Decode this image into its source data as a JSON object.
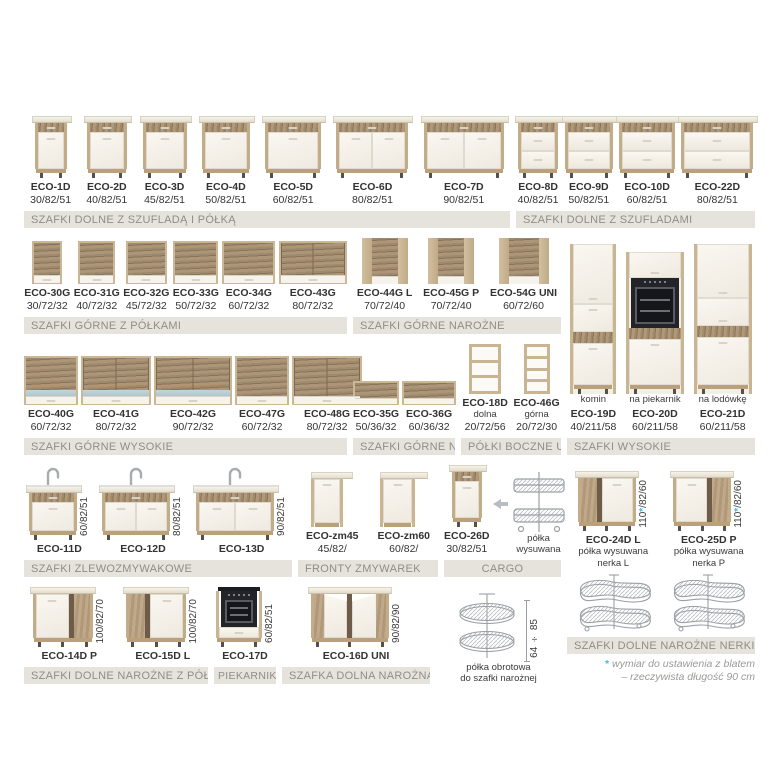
{
  "colors": {
    "accent": "#45b7e6",
    "bar_bg": "#e6e3dd",
    "bar_text": "#8f8d88",
    "text": "#3a3a3a",
    "line_art": "#9ba0a5",
    "wood": "#b0997a",
    "door": "#f7f4ed"
  },
  "sections": {
    "s1": {
      "title": "SZAFKI DOLNE Z SZUFLADĄ I PÓŁKĄ",
      "items": [
        {
          "name": "ECO-1D",
          "dims": "30/82/51",
          "kind": "base1",
          "w": 32
        },
        {
          "name": "ECO-2D",
          "dims": "40/82/51",
          "kind": "base1",
          "w": 40
        },
        {
          "name": "ECO-3D",
          "dims": "45/82/51",
          "kind": "base1",
          "w": 44
        },
        {
          "name": "ECO-4D",
          "dims": "50/82/51",
          "kind": "base1",
          "w": 48
        },
        {
          "name": "ECO-5D",
          "dims": "60/82/51",
          "kind": "base1",
          "w": 56
        },
        {
          "name": "ECO-6D",
          "dims": "80/82/51",
          "kind": "base2",
          "w": 72
        },
        {
          "name": "ECO-7D",
          "dims": "90/82/51",
          "kind": "base2",
          "w": 80
        }
      ]
    },
    "s2": {
      "title": "SZAFKI DOLNE Z SZUFLADAMI",
      "items": [
        {
          "name": "ECO-8D",
          "dims": "40/82/51",
          "kind": "drawers",
          "w": 40
        },
        {
          "name": "ECO-9D",
          "dims": "50/82/51",
          "kind": "drawers",
          "w": 48
        },
        {
          "name": "ECO-10D",
          "dims": "60/82/51",
          "kind": "drawers",
          "w": 56
        },
        {
          "name": "ECO-22D",
          "dims": "80/82/51",
          "kind": "drawers",
          "w": 72
        }
      ]
    },
    "s3": {
      "title": "SZAFKI GÓRNE Z PÓŁKAMI",
      "items": [
        {
          "name": "ECO-30G",
          "dims": "30/72/32",
          "kind": "wall",
          "w": 26
        },
        {
          "name": "ECO-31G",
          "dims": "40/72/32",
          "kind": "wall",
          "w": 33
        },
        {
          "name": "ECO-32G",
          "dims": "45/72/32",
          "kind": "wall",
          "w": 37
        },
        {
          "name": "ECO-33G",
          "dims": "50/72/32",
          "kind": "wall",
          "w": 41
        },
        {
          "name": "ECO-34G",
          "dims": "60/72/32",
          "kind": "wall",
          "w": 49
        },
        {
          "name": "ECO-43G",
          "dims": "80/72/32",
          "kind": "wall2",
          "w": 64
        }
      ]
    },
    "s4": {
      "title": "SZAFKI GÓRNE NAROŻNE",
      "items": [
        {
          "name": "ECO-44G L",
          "dims": "70/72/40",
          "kind": "cornerwall",
          "w": 46
        },
        {
          "name": "ECO-45G P",
          "dims": "70/72/40",
          "kind": "cornerwall",
          "w": 46
        },
        {
          "name": "ECO-54G UNI",
          "dims": "60/72/60",
          "kind": "cornerwall",
          "w": 50
        }
      ]
    },
    "s5": {
      "title": "SZAFKI GÓRNE WYSOKIE",
      "items": [
        {
          "name": "ECO-40G",
          "dims": "60/72/32",
          "kind": "wallhigh",
          "w": 50,
          "glass": true
        },
        {
          "name": "ECO-41G",
          "dims": "80/72/32",
          "kind": "wallhigh",
          "w": 66,
          "glass": true
        },
        {
          "name": "ECO-42G",
          "dims": "90/72/32",
          "kind": "wallhigh",
          "w": 74,
          "glass": true
        },
        {
          "name": "ECO-47G",
          "dims": "60/72/32",
          "kind": "wallhigh",
          "w": 50
        },
        {
          "name": "ECO-48G",
          "dims": "80/72/32",
          "kind": "wallhigh",
          "w": 66
        }
      ]
    },
    "s6": {
      "title": "SZAFKI GÓRNE NISKIE",
      "items": [
        {
          "name": "ECO-35G",
          "dims": "50/36/32",
          "kind": "walllow",
          "w": 42
        },
        {
          "name": "ECO-36G",
          "dims": "60/36/32",
          "kind": "walllow",
          "w": 50
        }
      ]
    },
    "s7": {
      "title": "PÓŁKI BOCZNE UNI",
      "items": [
        {
          "name": "ECO-18D",
          "note": "dolna",
          "dims": "20/72/56",
          "kind": "shelf",
          "w": 26,
          "shelves": 2
        },
        {
          "name": "ECO-46G",
          "note": "górna",
          "dims": "20/72/30",
          "kind": "shelf",
          "w": 20,
          "shelves": 3
        }
      ]
    },
    "s8": {
      "title": "SZAFKI WYSOKIE",
      "items": [
        {
          "name": "ECO-19D",
          "above": "komin",
          "dims": "40/211/58",
          "kind": "tall",
          "w": 40
        },
        {
          "name": "ECO-20D",
          "above": "na piekarnik",
          "dims": "60/211/58",
          "kind": "talloven",
          "w": 52
        },
        {
          "name": "ECO-21D",
          "above": "na lodówkę",
          "dims": "60/211/58",
          "kind": "tallfridge",
          "w": 52
        }
      ]
    },
    "s9": {
      "title": "SZAFKI ZLEWOZMYWAKOWE",
      "items": [
        {
          "name": "ECO-11D",
          "vdim": "60/82/51",
          "kind": "sink",
          "doors": 1,
          "w": 48
        },
        {
          "name": "ECO-12D",
          "vdim": "80/82/51",
          "kind": "sink",
          "doors": 2,
          "w": 68
        },
        {
          "name": "ECO-13D",
          "vdim": "90/82/51",
          "kind": "sink",
          "doors": 2,
          "w": 78
        }
      ]
    },
    "s10": {
      "title": "FRONTY ZMYWAREK",
      "items": [
        {
          "name": "ECO-zm45",
          "dims": "45/82/",
          "kind": "dwfront",
          "w": 42
        },
        {
          "name": "ECO-zm60",
          "dims": "60/82/",
          "kind": "dwfront",
          "w": 48
        }
      ]
    },
    "s11": {
      "title": "CARGO",
      "items": [
        {
          "name": "ECO-26D",
          "dims": "30/82/51",
          "kind": "base1",
          "w": 30
        },
        {
          "kind": "arrow"
        },
        {
          "caption": [
            "półka",
            "wysuwana"
          ],
          "kind": "cargo"
        }
      ]
    },
    "s12": {
      "title": "SZAFKI DOLNE NAROŻNE Z PÓŁKĄ",
      "items": [
        {
          "name": "ECO-14D P",
          "vdim": "100/82/70",
          "kind": "cornerbase",
          "side": "P",
          "w": 60
        },
        {
          "name": "ECO-15D L",
          "vdim": "100/82/70",
          "kind": "cornerbase",
          "side": "L",
          "w": 60
        }
      ]
    },
    "s13": {
      "title": "PIEKARNIK",
      "items": [
        {
          "name": "ECO-17D",
          "vdim": "60/82/51",
          "kind": "ovenbase",
          "w": 46
        }
      ]
    },
    "s14": {
      "title": "SZAFKA DOLNA NAROŻNA",
      "items": [
        {
          "name": "ECO-16D UNI",
          "vdim": "90/82/90",
          "kind": "corneruni",
          "w": 78
        }
      ]
    },
    "s15": {
      "title": "",
      "items": [
        {
          "caption": [
            "półka obrotowa",
            "do szafki narożnej"
          ],
          "vdim": "64 ÷ 85",
          "kind": "carousel"
        }
      ]
    },
    "s16": {
      "title": "SZAFKI DOLNE NAROŻNE NERKI",
      "items": [
        {
          "name": "ECO-24D L",
          "note2": [
            "półka wysuwana",
            "nerka L"
          ],
          "vdim": "110*/82/60",
          "kind": "cornerbase",
          "side": "L",
          "w": 58
        },
        {
          "name": "ECO-25D P",
          "note2": [
            "półka wysuwana",
            "nerka P"
          ],
          "vdim": "110*/82/60",
          "kind": "cornerbase",
          "side": "P",
          "w": 58
        }
      ],
      "images": [
        {
          "kind": "nerka"
        },
        {
          "kind": "nerka"
        }
      ],
      "footnote": {
        "star": "*",
        "line1": "wymiar do ustawienia z blatem",
        "line2": "– rzeczywista długość 90 cm"
      }
    }
  }
}
